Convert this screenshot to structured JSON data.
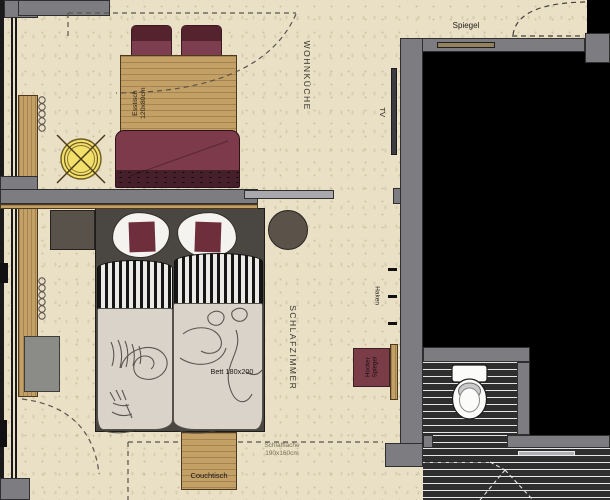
{
  "rooms": {
    "living_kitchen": {
      "label": "WOHNKÜCHE"
    },
    "bedroom": {
      "label": "SCHLAFZIMMER"
    }
  },
  "items": {
    "mirror_wall": {
      "label": "Spiegel"
    },
    "tv": {
      "label": "TV"
    },
    "hooks": {
      "label": "Haken"
    },
    "stool": {
      "line1": "Hocker",
      "line2": "Spiegel"
    },
    "dining_table": {
      "line1": "Esstisch",
      "line2": "120x80cm"
    },
    "bed": {
      "label": "Bett 180x200"
    },
    "sofa_bed_area": {
      "line1": "Schlaffläche",
      "line2": "190x160cm"
    },
    "coffee_table": {
      "label": "Couchtisch"
    }
  },
  "colors": {
    "floor": "#e9e0c6",
    "wall": "#7c7c81",
    "wood": "#c2a066",
    "chair_red": "#7d3f50",
    "sofa_red": "#7d3a4a",
    "pillow_red": "#6e2e3c",
    "stool_red": "#7a3c46",
    "lamp_yellow": "#f3e06a",
    "tile_dark": "#2e2e2e",
    "duvet": "#d9d3ca",
    "void": "#000000"
  }
}
